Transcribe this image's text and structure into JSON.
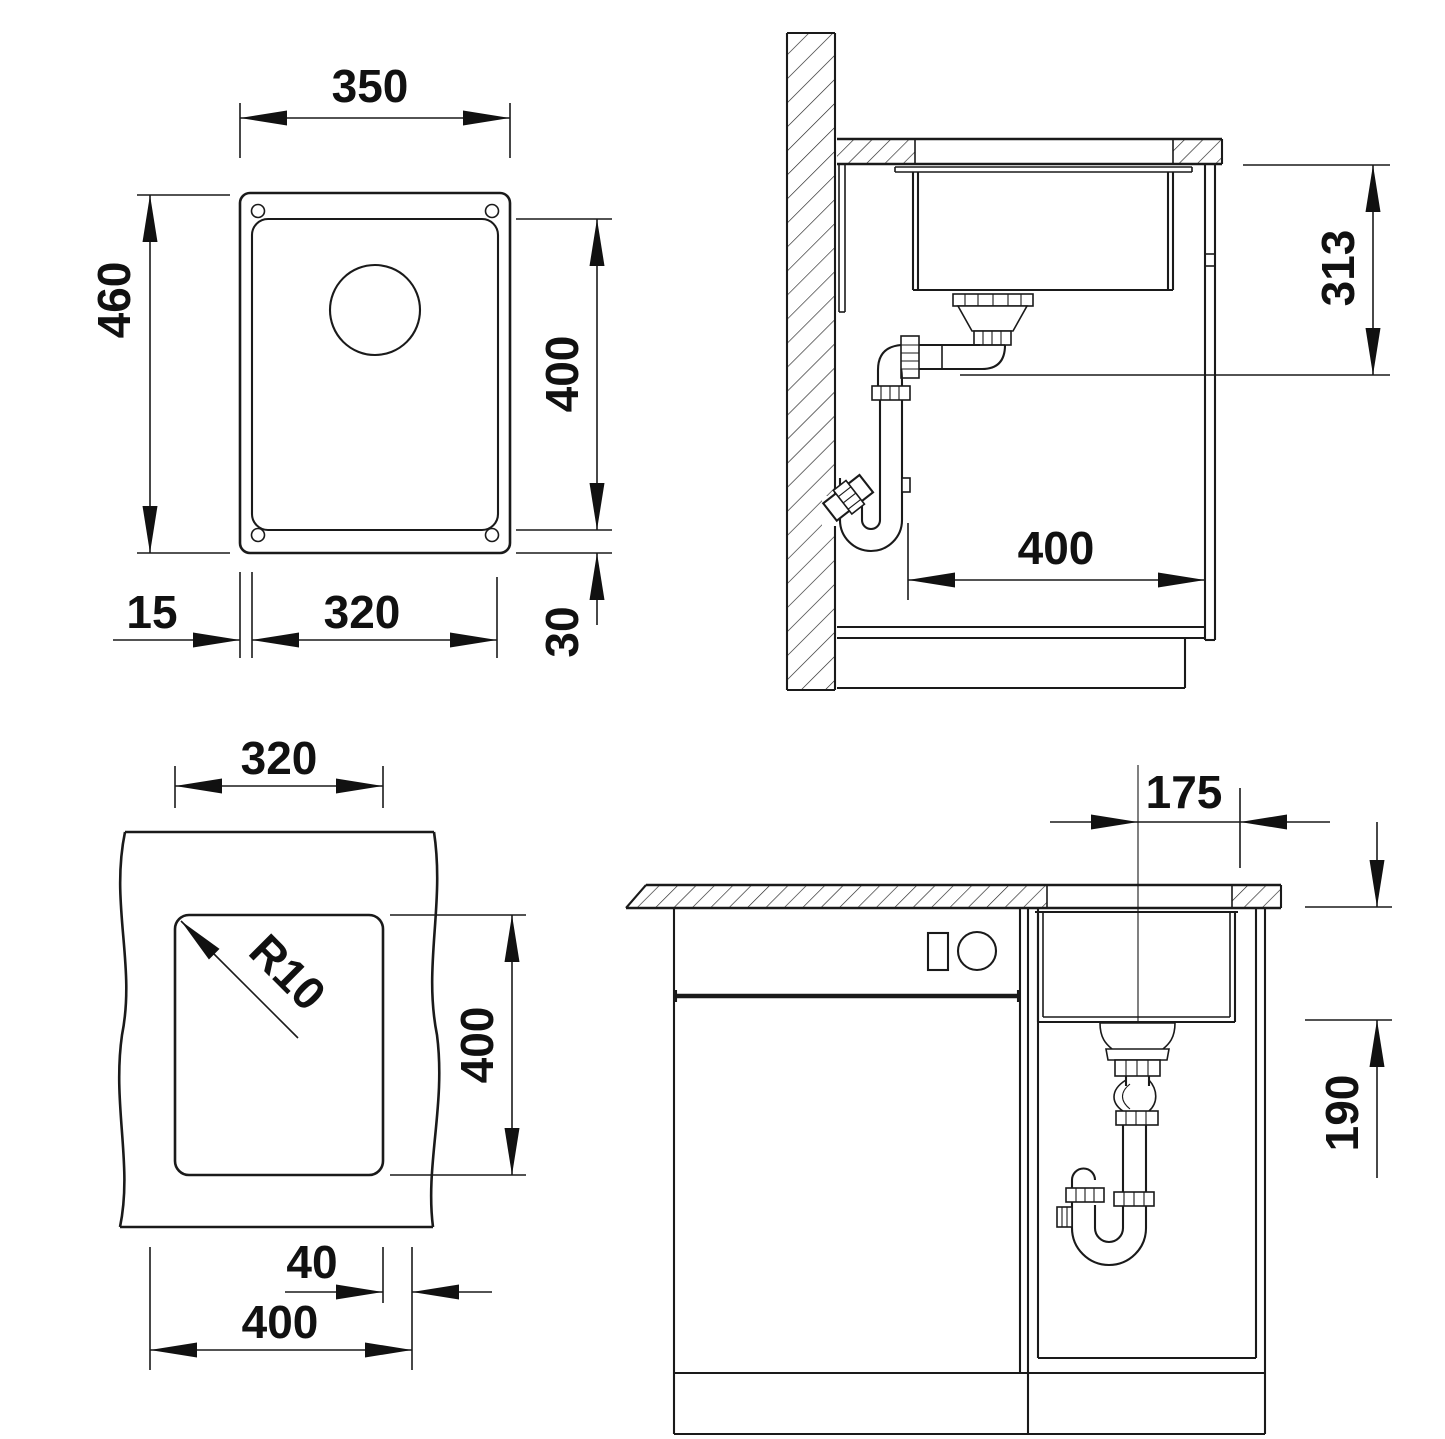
{
  "drawing": {
    "type": "sink installation technical drawing",
    "colors": {
      "line": "#1a1a1a",
      "background": "#ffffff"
    }
  },
  "dims": {
    "top_view": {
      "overall_width": "350",
      "overall_height": "460",
      "bowl_length": "400",
      "flange_left": "15",
      "bowl_width": "320",
      "flange_bottom": "30"
    },
    "side_view": {
      "install_depth": "313",
      "cabinet_depth": "400"
    },
    "cutout_view": {
      "cutout_width": "320",
      "corner_radius": "R10",
      "cutout_length": "400",
      "edge_distance": "40",
      "cabinet_width": "400"
    },
    "front_view": {
      "drain_center_offset": "175",
      "bowl_depth": "190"
    }
  }
}
